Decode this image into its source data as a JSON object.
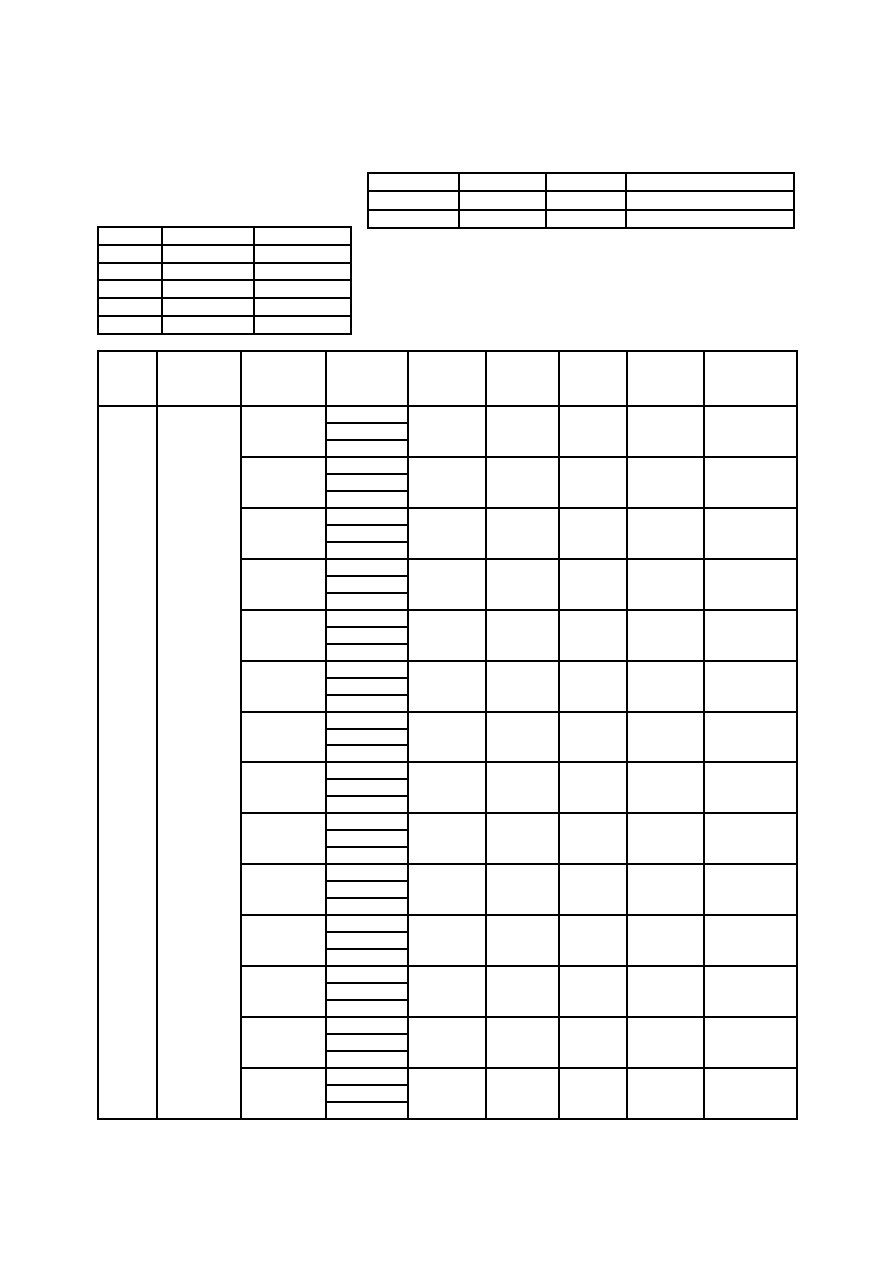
{
  "page": {
    "background_color": "#ffffff",
    "line_color": "#000000",
    "visible_text": ""
  },
  "tables": {
    "top_right": {
      "description": "empty table, top right of page",
      "rows": 3,
      "columns": 4,
      "cell_text": ""
    },
    "left": {
      "description": "empty table, upper left of page",
      "rows": 6,
      "columns": 3,
      "cell_text": ""
    },
    "main": {
      "description": "large empty table, lower portion of page",
      "header_rows": 1,
      "header_columns": 9,
      "body_rows": 14,
      "merged_full_height_columns": 2,
      "column4_subrows_per_body_row": 3,
      "cell_text": ""
    }
  }
}
